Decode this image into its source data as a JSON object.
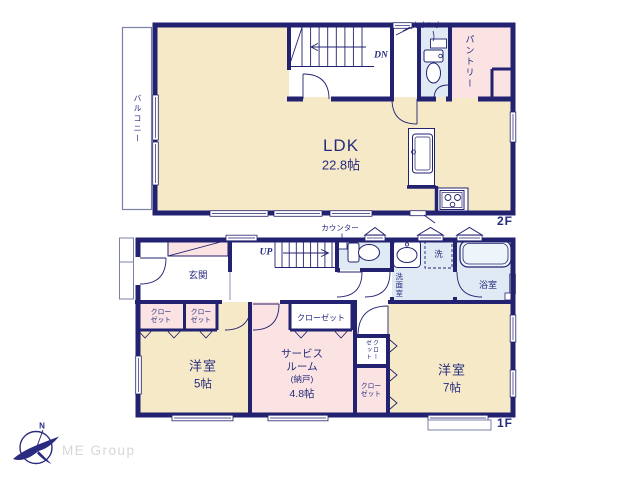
{
  "colors": {
    "wall_navy": "#232270",
    "text_navy": "#242b7e",
    "room_cream": "#f6e9c8",
    "room_pink": "#fae3e2",
    "room_blue": "#dfeaf4",
    "logo_gray": "#d7d7d7"
  },
  "floor2": {
    "floor_label": "2F",
    "balcony": "バルコニー",
    "ldk_name": "LDK",
    "ldk_size": "22.8帖",
    "stairs_dir": "DN",
    "counter": "カウンター",
    "pantry": "パントリー"
  },
  "floor1": {
    "floor_label": "1F",
    "counter": "カウンター",
    "stairs_dir": "UP",
    "entrance": "玄関",
    "laundry": "洗",
    "washroom": "洗面室",
    "bathroom": "浴室",
    "room5_name": "洋室",
    "room5_size": "5帖",
    "service_line1": "サービス",
    "service_line2": "ルーム",
    "service_line3": "(納戸)",
    "service_line4": "4.8帖",
    "room7_name": "洋室",
    "room7_size": "7帖",
    "closet_line1": "クロー",
    "closet_line2": "ゼット",
    "closet_full": "クローゼット"
  },
  "branding": {
    "company": "ME Group",
    "north": "N"
  }
}
